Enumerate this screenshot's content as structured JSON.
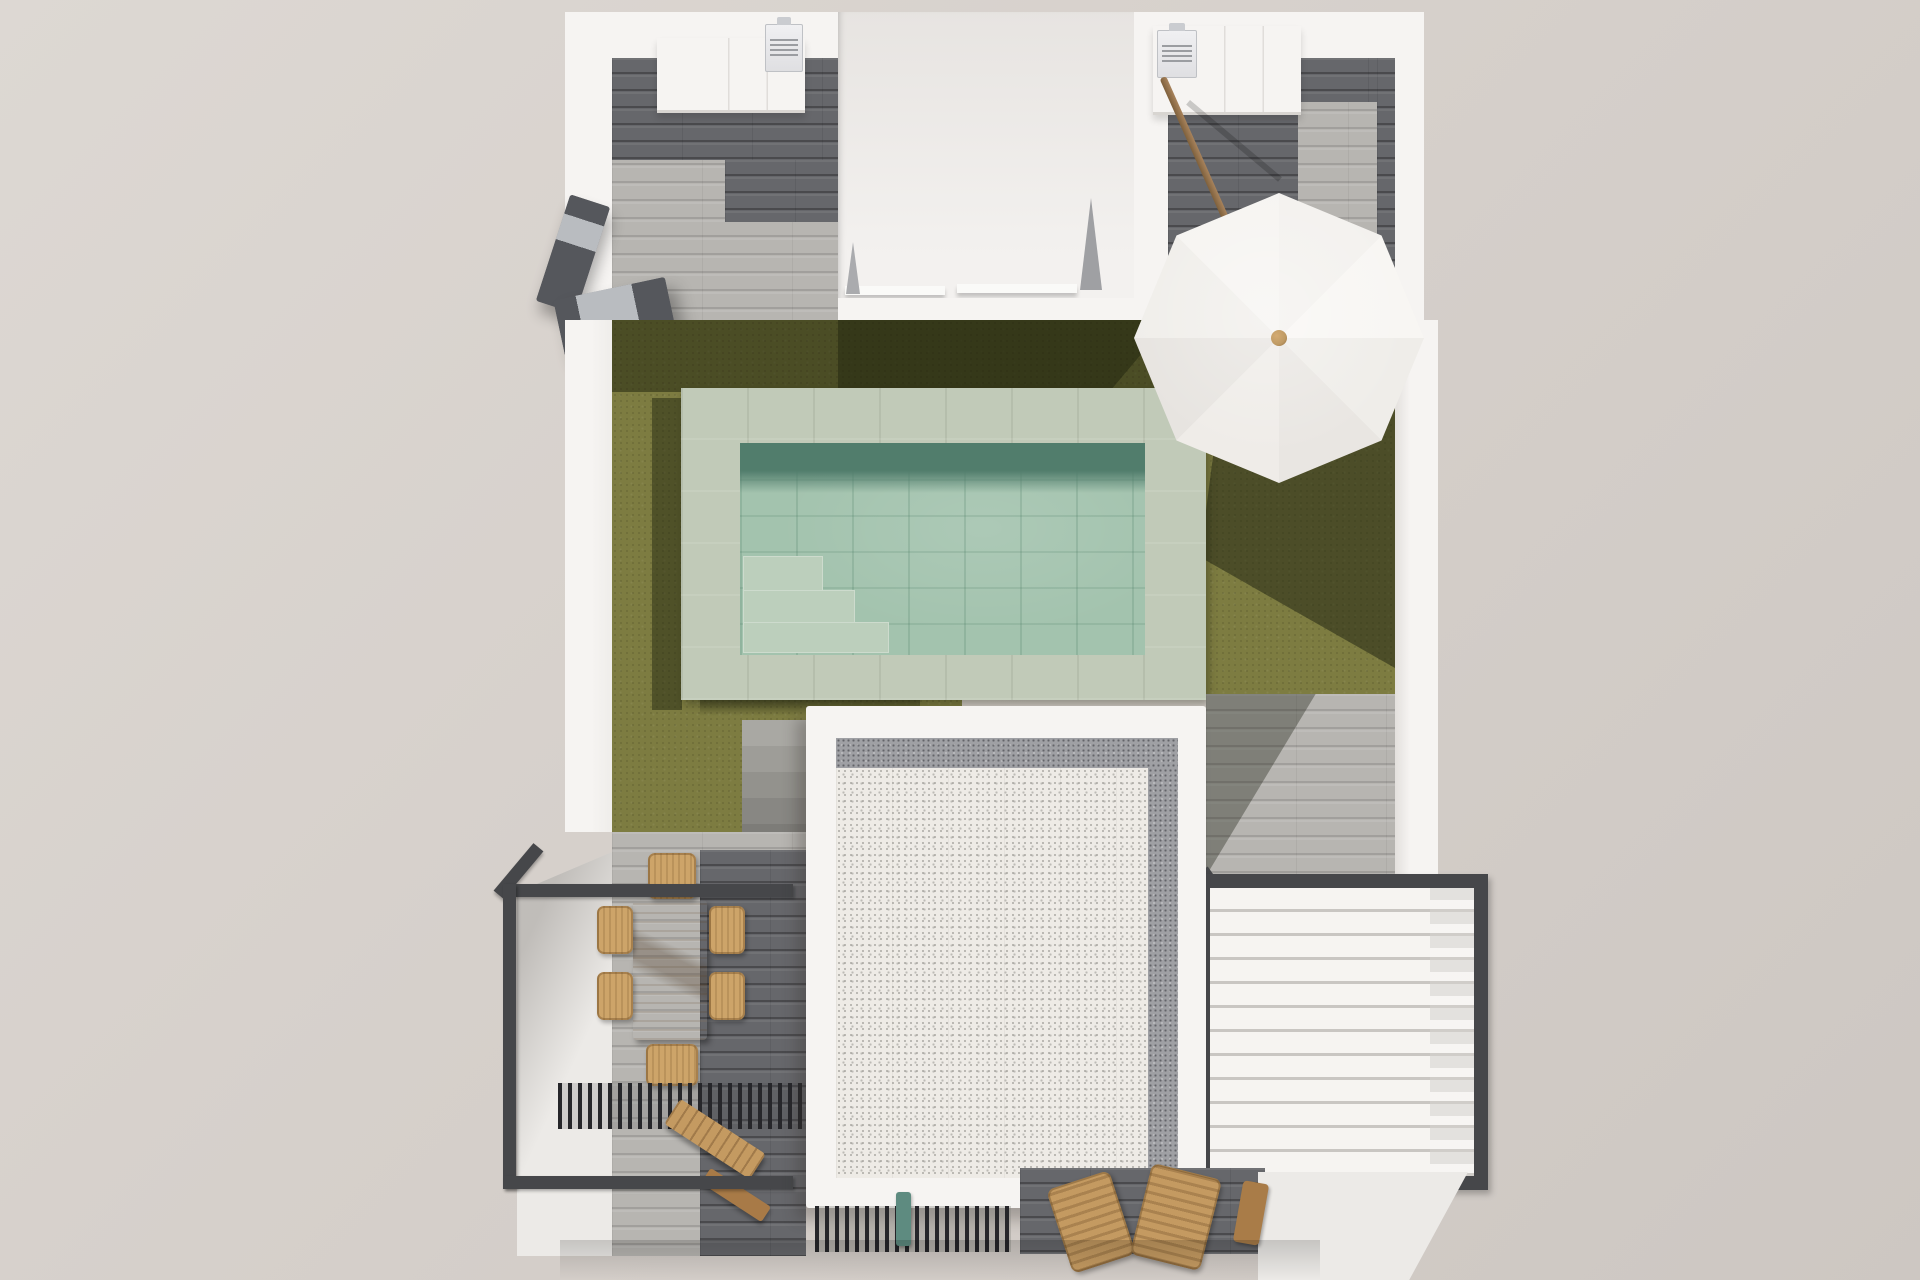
{
  "scene": {
    "description": "Top-down 3D architectural render of a villa roof terrace and garden: U-shaped white building with two upper patios, artificial lawn with tiled swimming pool, tilted white parasol, white gravel flat roof, louvered pergola, outdoor dining set, balcony railing and wooden lounge chairs",
    "objects": [
      {
        "name": "building-walls",
        "color": "#f6f4f2"
      },
      {
        "name": "upper-left-patio-floor",
        "material": "grey wood planks",
        "color": "#66676b"
      },
      {
        "name": "upper-right-patio-floor",
        "material": "grey wood planks",
        "color": "#b7b5b1"
      },
      {
        "name": "kitchen-counters",
        "count": 2,
        "color": "#f6f4f2"
      },
      {
        "name": "air-conditioner-units",
        "count": 2,
        "color": "#ebebed"
      },
      {
        "name": "wall-mounted-stair-rail",
        "color": "#55575c"
      },
      {
        "name": "lawn",
        "color": "#7d7c41"
      },
      {
        "name": "pool-deck",
        "color": "#c1cab8"
      },
      {
        "name": "swimming-pool",
        "water_color": "#a3c3ae",
        "shadow_color": "#517d6c",
        "steps": 3
      },
      {
        "name": "parasol",
        "color": "#f4f2ef",
        "segments": 8,
        "pole_color": "#a8835c",
        "knob_color": "#bf9a64"
      },
      {
        "name": "garden-stairs",
        "steps": 5,
        "color": "#9b9a96"
      },
      {
        "name": "gravel-roof",
        "gravel_color": "#eeebe6",
        "border_color": "#f6f4f2",
        "grey_band_color": "#9fa0a4"
      },
      {
        "name": "louvered-pergola",
        "frame_color": "#46474a",
        "louver_color": "#f6f4f1",
        "louver_count": 12
      },
      {
        "name": "dining-table",
        "color": "#c2945a",
        "chair_count": 6,
        "chair_color": "#cda469"
      },
      {
        "name": "balcony-railing",
        "color": "#3a3b3d"
      },
      {
        "name": "slatted-shade-strips",
        "count": 2,
        "color": "#26262a"
      },
      {
        "name": "wooden-bench",
        "color": "#b5824e"
      },
      {
        "name": "wooden-lounge-chairs",
        "count": 2,
        "color": "#c49a61"
      },
      {
        "name": "teal-planter",
        "color": "#5e8b80"
      }
    ]
  },
  "colors": {
    "bg": "#d6d0cb",
    "wall": "#f6f4f2",
    "plank-light": "#b7b5b1",
    "plank-dark": "#66676b",
    "grass": "#7d7c41",
    "deck": "#c1cab8",
    "water": "#a3c3ae",
    "water-dark": "#517d6c",
    "pool-step": "#bccfbc",
    "gravel": "#eeebe6",
    "gravel-band": "#9fa0a4",
    "frame": "#46474a",
    "louver": "#f6f4f1",
    "slat": "#26262a",
    "table-wood": "#c2945a",
    "wicker": "#cda469",
    "bench-wood": "#c49a61",
    "grill": "#55575c",
    "grill-panel": "#b9bcc0",
    "ac-grey": "#9b9da1",
    "umbrella": "#f4f2ef",
    "knob": "#bf9a64",
    "pole": "#a8835c"
  }
}
